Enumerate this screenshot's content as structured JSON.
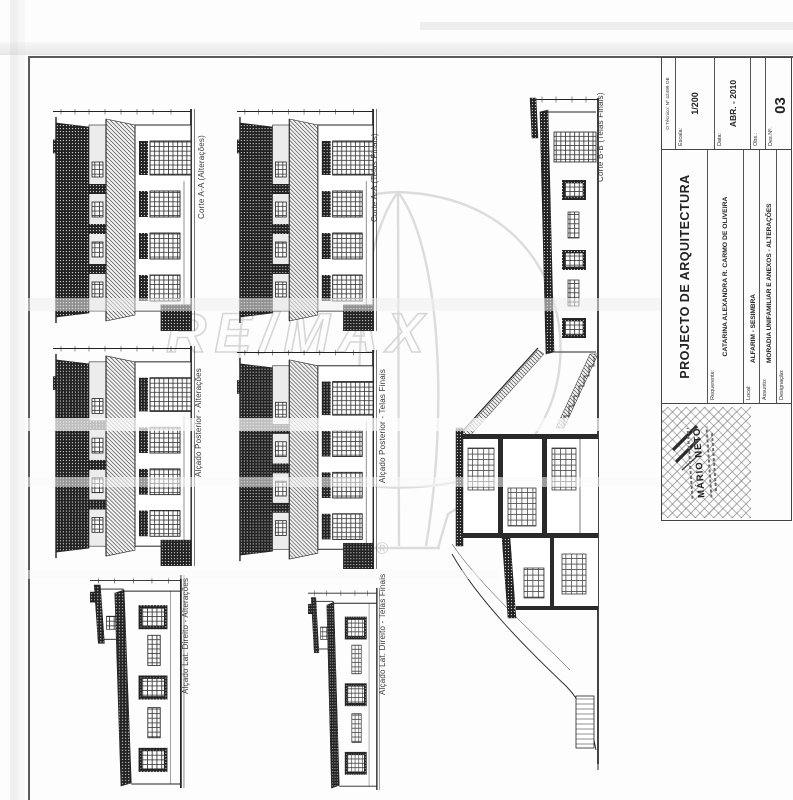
{
  "sheet": {
    "watermark": {
      "brand": "RE/MAX",
      "registered": "®"
    },
    "drawings": [
      {
        "id": "corte-aa-alteracoes",
        "caption": "Corte A-A (Alterações)"
      },
      {
        "id": "corte-aa-telas-finais",
        "caption": "Corte A-A (Telas Finais)"
      },
      {
        "id": "alcado-posterior-alteracoes",
        "caption": "Alçado Posterior - Alterações"
      },
      {
        "id": "alcado-posterior-telas-finais",
        "caption": "Alçado Posterior - Telas Finais"
      },
      {
        "id": "alcado-lat-direito-alteracoes",
        "caption": "Alçado Lat. Direito - Alterações"
      },
      {
        "id": "alcado-lat-direito-telas-finais",
        "caption": "Alçado Lat. Direito - Telas Finais"
      },
      {
        "id": "corte-bb-telas-finais",
        "caption": "Corte B-B (Telas Finais)"
      }
    ],
    "title_block": {
      "technician_note": "O Técnico: Nº 42499 OE",
      "title": "PROJECTO DE ARQUITECTURA",
      "requerente_label": "Requerente:",
      "requerente_value": "CATARINA ALEXANDRA R. CARMO DE OLIVEIRA",
      "local_label": "Local:",
      "local_value": "ALFARIM - SESIMBRA",
      "assunto_label": "Assunto:",
      "assunto_value": "MORADIA UNIFAMILIAR  E ANEXOS - ALTERAÇÕES",
      "designacao_label": "Designação:",
      "escala_label": "Escala:",
      "escala_value": "1/200",
      "data_label": "Data:",
      "data_value": "ABR. - 2010",
      "obs_label": "Obs.:",
      "des_no_label": "Des.Nº.",
      "des_no_value": "03",
      "stamp_name": "MÁRIO NETO"
    },
    "colors": {
      "ink": "#222222",
      "watermark_gray": "#d7d7d7",
      "paper": "#fdfdfd",
      "border": "#555555"
    }
  }
}
